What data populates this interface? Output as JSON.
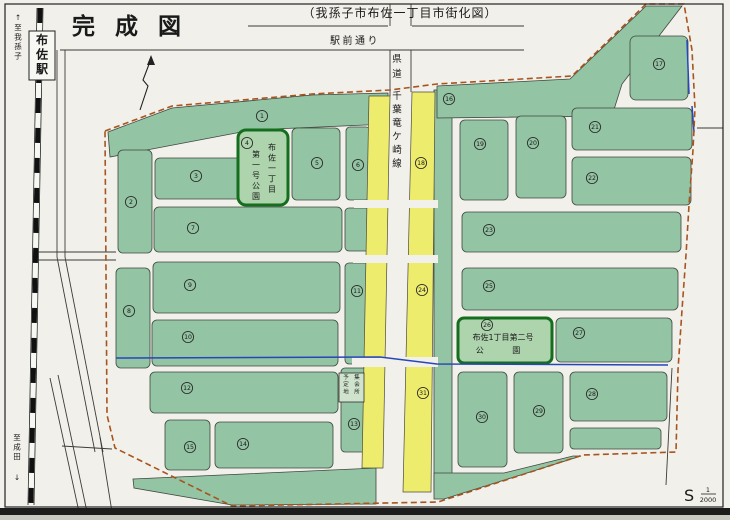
{
  "title": "完成図",
  "caption": "（我孫子市布佐一丁目市街化図）",
  "labels": {
    "ekimae_street": "駅前通り",
    "kendo_prefix": "県道",
    "kendo_line": "千葉竜ケ崎線",
    "station": "布佐駅",
    "to_abiko": "至我孫子",
    "to_narita": "至成田",
    "to_abiko_arrow": "↑",
    "to_narita_arrow": "↓"
  },
  "hall": {
    "col_right": "集会所",
    "col_left": "予定地"
  },
  "parks": {
    "park1": {
      "number": "4",
      "col_right": "布佐一丁目",
      "col_left": "第一号公園"
    },
    "park2": {
      "number": "26",
      "line1": "布佐1丁目第二号",
      "line2": "公 園"
    }
  },
  "scale": {
    "prefix": "S",
    "numerator": "1",
    "denominator": "2000"
  },
  "blocks": [
    {
      "n": "1",
      "x": 262,
      "y": 116
    },
    {
      "n": "2",
      "x": 131,
      "y": 202
    },
    {
      "n": "3",
      "x": 196,
      "y": 176
    },
    {
      "n": "4",
      "x": 247,
      "y": 143
    },
    {
      "n": "5",
      "x": 317,
      "y": 163
    },
    {
      "n": "6",
      "x": 358,
      "y": 165
    },
    {
      "n": "7",
      "x": 193,
      "y": 228
    },
    {
      "n": "8",
      "x": 129,
      "y": 311
    },
    {
      "n": "9",
      "x": 190,
      "y": 285
    },
    {
      "n": "10",
      "x": 188,
      "y": 337
    },
    {
      "n": "11",
      "x": 357,
      "y": 291
    },
    {
      "n": "12",
      "x": 187,
      "y": 388
    },
    {
      "n": "13",
      "x": 354,
      "y": 424
    },
    {
      "n": "14",
      "x": 243,
      "y": 444
    },
    {
      "n": "15",
      "x": 190,
      "y": 447
    },
    {
      "n": "16",
      "x": 449,
      "y": 99
    },
    {
      "n": "17",
      "x": 659,
      "y": 64
    },
    {
      "n": "18",
      "x": 421,
      "y": 163
    },
    {
      "n": "19",
      "x": 480,
      "y": 144
    },
    {
      "n": "20",
      "x": 533,
      "y": 143
    },
    {
      "n": "21",
      "x": 595,
      "y": 127
    },
    {
      "n": "22",
      "x": 592,
      "y": 178
    },
    {
      "n": "23",
      "x": 489,
      "y": 230
    },
    {
      "n": "24",
      "x": 422,
      "y": 290
    },
    {
      "n": "25",
      "x": 489,
      "y": 286
    },
    {
      "n": "26",
      "x": 487,
      "y": 325
    },
    {
      "n": "27",
      "x": 579,
      "y": 333
    },
    {
      "n": "28",
      "x": 592,
      "y": 394
    },
    {
      "n": "29",
      "x": 539,
      "y": 411
    },
    {
      "n": "30",
      "x": 482,
      "y": 417
    },
    {
      "n": "31",
      "x": 423,
      "y": 393
    }
  ],
  "colors": {
    "paper": "#f1f0ea",
    "block_green": "#93c4a4",
    "park_green": "#aed4ae",
    "road_yellow": "#eeec6d",
    "boundary": "#a8541e",
    "water": "#2746b8"
  }
}
